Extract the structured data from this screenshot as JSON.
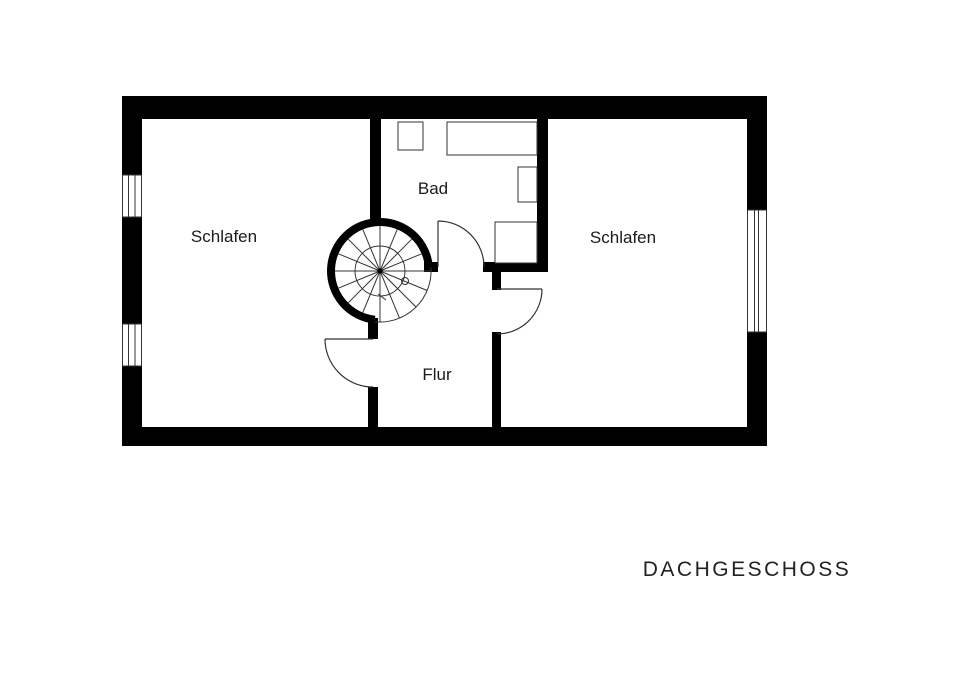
{
  "title": "DACHGESCHOSS",
  "rooms": [
    {
      "id": "schlafen-left",
      "label": "Schlafen"
    },
    {
      "id": "bad",
      "label": "Bad"
    },
    {
      "id": "schlafen-right",
      "label": "Schlafen"
    },
    {
      "id": "flur",
      "label": "Flur"
    }
  ],
  "features": {
    "staircase": "spiral-staircase",
    "window_count": 3,
    "door_count": 3,
    "bath_fixtures": [
      "sink",
      "bathtub",
      "toilet",
      "shower"
    ]
  },
  "colors": {
    "wall": "#000000",
    "background": "#ffffff",
    "thin_line": "#333333",
    "text": "#1a1a1a"
  }
}
